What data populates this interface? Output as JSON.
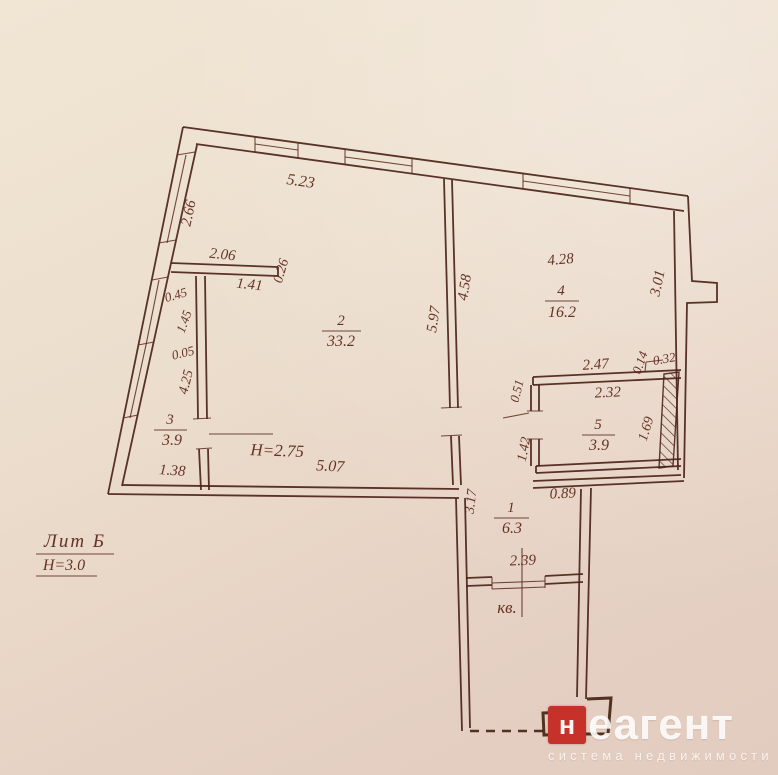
{
  "labels": {
    "lit": "Лит Б",
    "building_height": "Н=3.0",
    "ceiling_height": "H=2.75",
    "kv": "кв."
  },
  "rooms": {
    "r1": {
      "number": "1",
      "area": "6.3"
    },
    "r2": {
      "number": "2",
      "area": "33.2"
    },
    "r3": {
      "number": "3",
      "area": "3.9"
    },
    "r4": {
      "number": "4",
      "area": "16.2"
    },
    "r5": {
      "number": "5",
      "area": "3.9"
    }
  },
  "dims": {
    "d5_23": "5.23",
    "d2_66": "2.66",
    "d2_06": "2.06",
    "d0_26": "0.26",
    "d1_41": "1.41",
    "d0_45": "0.45",
    "d1_45": "1.45",
    "d0_05": "0.05",
    "d4_25": "4.25",
    "d1_38": "1.38",
    "d5_07": "5.07",
    "d5_97": "5.97",
    "d4_58": "4.58",
    "d4_28": "4.28",
    "d3_01": "3.01",
    "d2_47": "2.47",
    "d0_14": "0.14",
    "d0_32": "0.32",
    "d0_51": "0.51",
    "d2_32": "2.32",
    "d1_69": "1.69",
    "d1_42": "1.42",
    "d0_89": "0.89",
    "d3_17": "3.17",
    "d2_39": "2.39"
  },
  "watermark": {
    "brand_initial": "н",
    "brand_rest": "еагент",
    "tagline": "система недвижимости",
    "red": "#c63129"
  },
  "colors": {
    "paper": "#ebdccb",
    "ink": "#4c2319"
  }
}
